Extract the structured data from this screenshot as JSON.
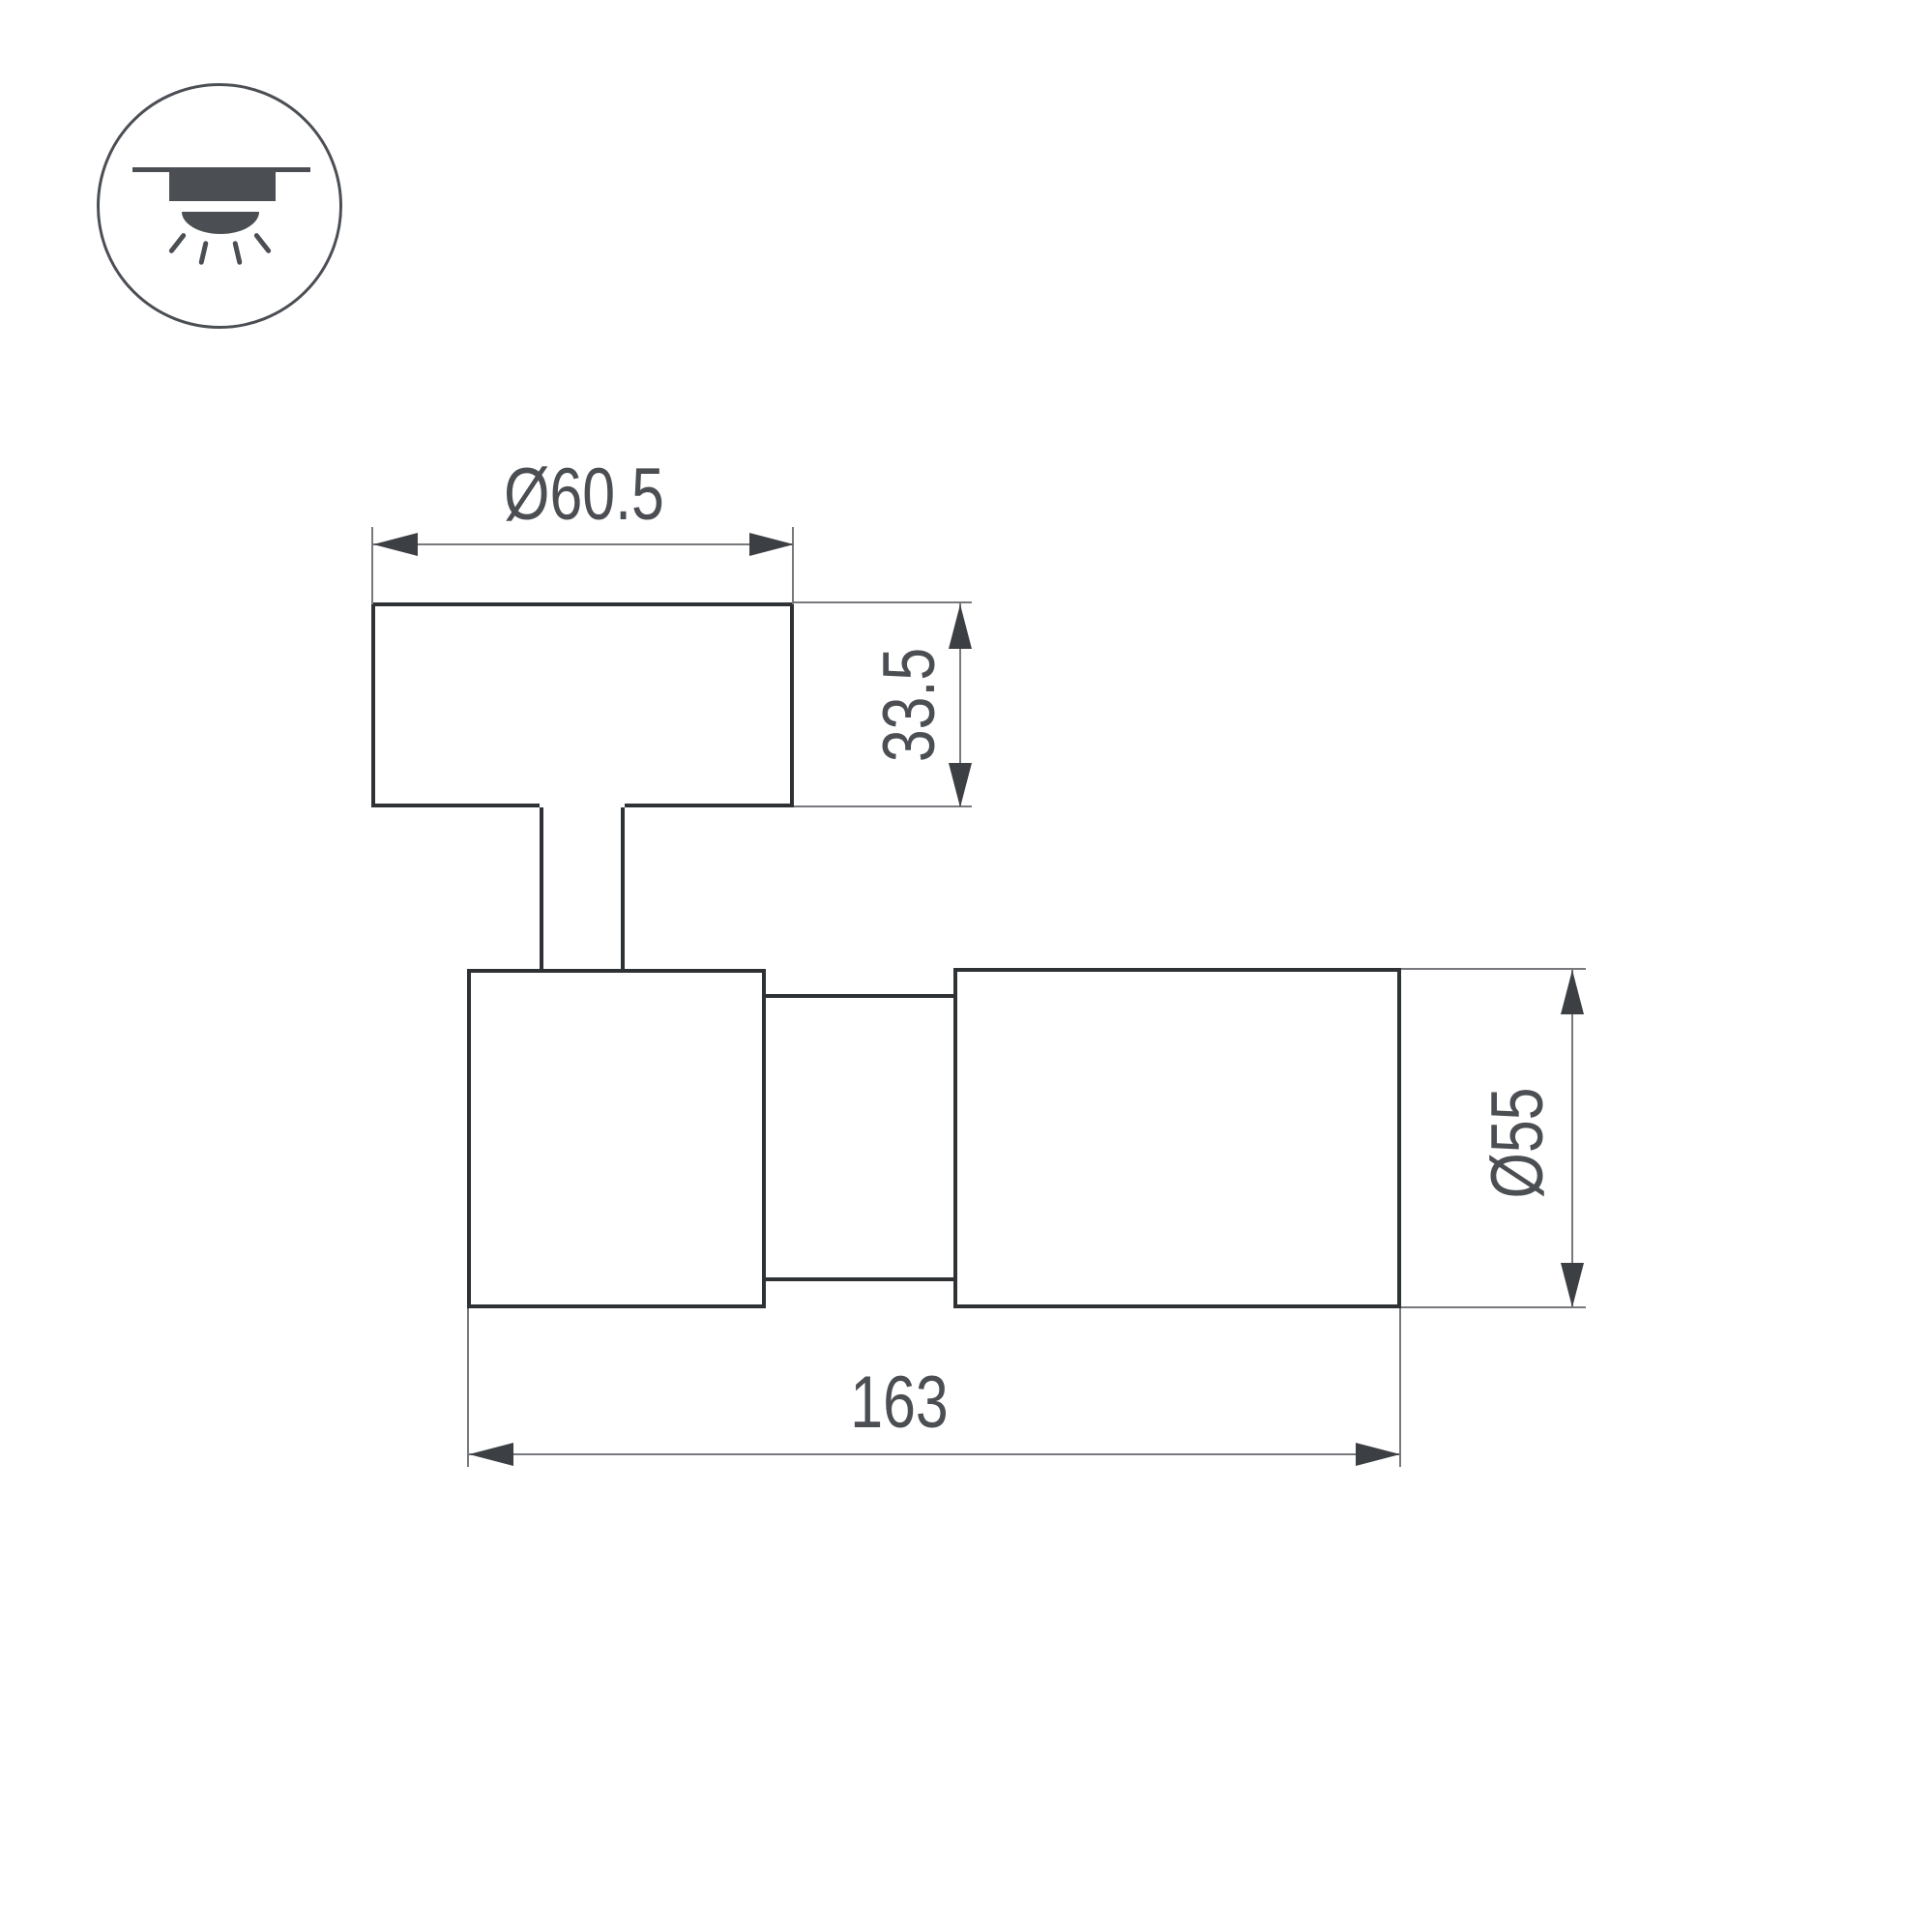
{
  "drawing": {
    "title": "luminaire-dimension-drawing",
    "icon": {
      "name": "surface-ceiling-mount-light-icon",
      "meaning": "ceiling mounted luminaire shining downward"
    },
    "colors": {
      "outline": "#2f3235",
      "dimension": "#77797c",
      "arrow": "#3c3f43",
      "text": "#4b4e52",
      "icon": "#4b4f54",
      "background": "#ffffff"
    },
    "dimensions": {
      "top_diameter": {
        "label": "Ø60.5",
        "value": 60.5
      },
      "base_height": {
        "label": "33.5",
        "value": 33.5
      },
      "body_diameter": {
        "label": "Ø55",
        "value": 55
      },
      "overall_length": {
        "label": "163",
        "value": 163
      }
    }
  }
}
